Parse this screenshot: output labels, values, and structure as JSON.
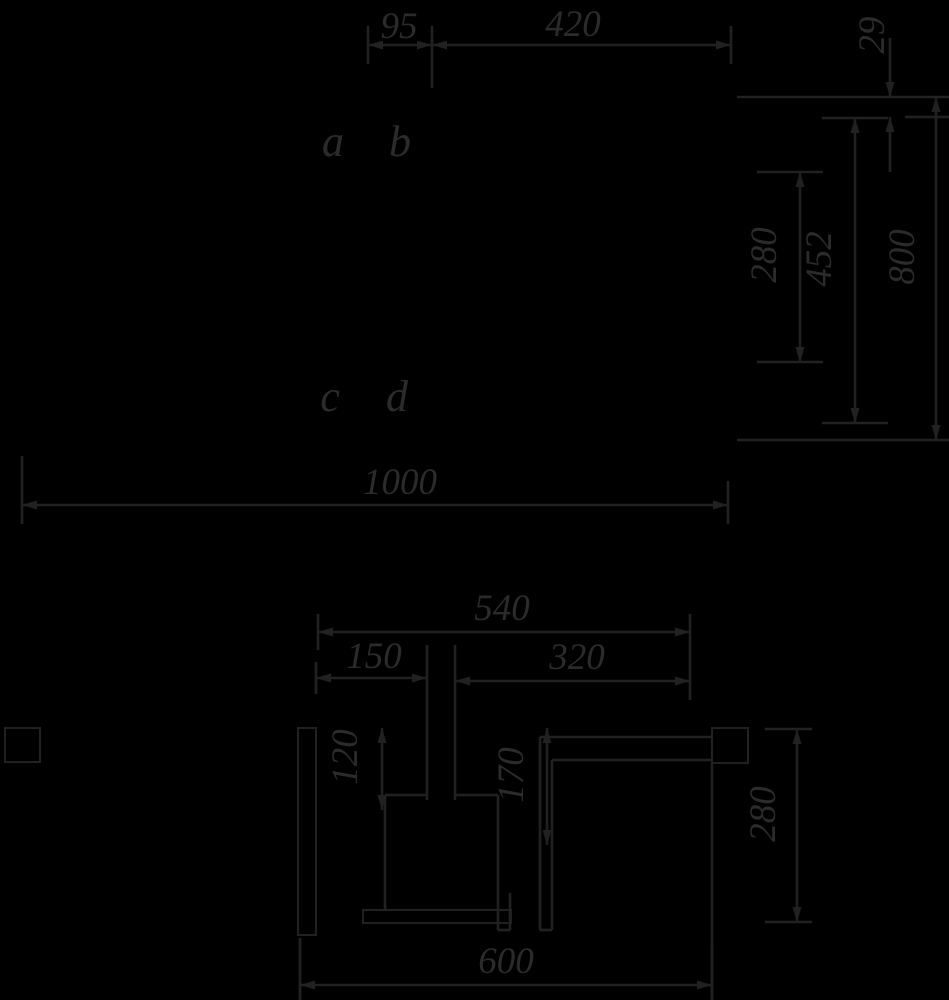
{
  "title": "installation-dimension-drawing",
  "colors": {
    "background": "#000000",
    "line": "#212121",
    "text": "#2b2b2b"
  },
  "front_view": {
    "width_left": "95",
    "width_right": "420",
    "width_total": "1000",
    "point_a": "a",
    "point_b": "b",
    "point_c": "c",
    "point_d": "d",
    "offset_top": "29",
    "height_inner": "280",
    "height_mid": "452",
    "height_total": "800"
  },
  "section_view": {
    "width_top": "540",
    "width_left": "150",
    "width_right": "320",
    "width_bottom": "600",
    "depth_left": "120",
    "depth_mid": "170",
    "height_right": "280"
  }
}
